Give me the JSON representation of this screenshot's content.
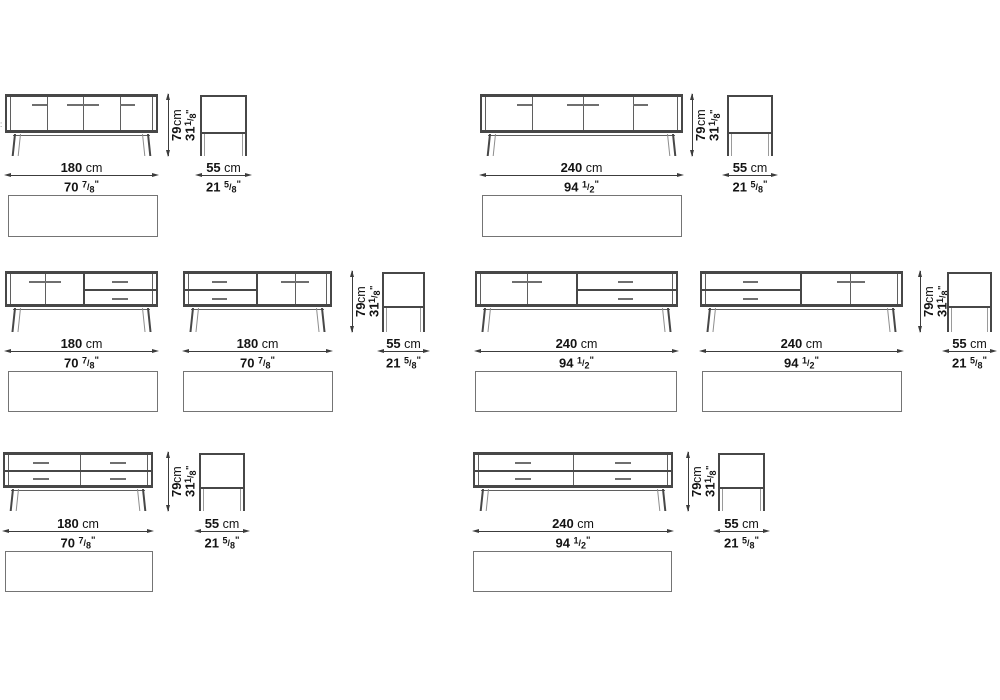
{
  "sheet": {
    "kind": "sideboard technical drawing spec sheet"
  },
  "colors": {
    "frame": "#474747",
    "thin": "#5f5f5f",
    "handle": "#6f6f6f",
    "dim": "#3c3c3c",
    "text": "#141414",
    "plan_border": "#747474"
  },
  "dim_labels": {
    "width_180": {
      "cm": "180",
      "cm_unit": "cm",
      "in": "70",
      "frac_n": "7",
      "frac_d": "8",
      "in_unit": "\""
    },
    "width_240": {
      "cm": "240",
      "cm_unit": "cm",
      "in": "94",
      "frac_n": "1",
      "frac_d": "2",
      "in_unit": "\""
    },
    "height": {
      "cm": "79",
      "cm_unit": "cm",
      "in": "31",
      "frac_n": "1",
      "frac_d": "8",
      "in_unit": "\""
    },
    "depth": {
      "cm": "55",
      "cm_unit": "cm",
      "in": "21",
      "frac_n": "5",
      "frac_d": "8",
      "in_unit": "\""
    }
  },
  "edge_artifact": {
    "text": ":",
    "x": 0,
    "y": 121
  },
  "rows": [
    {
      "front_top": 94,
      "body_h": 39,
      "leg_bottom": 156,
      "dim_cm_y": 161,
      "dim_line_y": 175,
      "dim_in_y": 178,
      "plan_y": 195,
      "plan_h": 42
    },
    {
      "front_top": 271,
      "body_h": 36,
      "leg_bottom": 332,
      "dim_cm_y": 337,
      "dim_line_y": 351,
      "dim_in_y": 354,
      "plan_y": 371,
      "plan_h": 41
    },
    {
      "front_top": 452,
      "body_h": 36,
      "leg_bottom": 511,
      "dim_cm_y": 517,
      "dim_line_y": 531,
      "dim_in_y": 534,
      "plan_y": 551,
      "plan_h": 41
    }
  ],
  "variants": [
    {
      "name": "sideboard-180-four-doors",
      "row": 0,
      "front": {
        "x": 5,
        "w": 153
      },
      "thin_vlines": [
        42,
        78,
        115
      ],
      "thick_vlines": [],
      "hline": null,
      "handles": [
        {
          "x1": 27,
          "x2": 42,
          "y": 10
        },
        {
          "x1": 62,
          "x2": 94,
          "y": 10
        },
        {
          "x1": 115,
          "x2": 130,
          "y": 10
        }
      ],
      "width_label": "width_180",
      "height_dim_x": 168,
      "side": {
        "x": 200,
        "w": 47
      },
      "plan": {
        "x": 8,
        "w": 150
      }
    },
    {
      "name": "sideboard-240-four-doors",
      "row": 0,
      "front": {
        "x": 480,
        "w": 203
      },
      "thin_vlines": [
        52,
        103,
        153
      ],
      "thick_vlines": [],
      "hline": null,
      "handles": [
        {
          "x1": 37,
          "x2": 52,
          "y": 10
        },
        {
          "x1": 87,
          "x2": 119,
          "y": 10
        },
        {
          "x1": 153,
          "x2": 168,
          "y": 10
        }
      ],
      "width_label": "width_240",
      "height_dim_x": 692,
      "side": {
        "x": 727,
        "w": 46
      },
      "plan": {
        "x": 482,
        "w": 200
      }
    },
    {
      "name": "sideboard-180-doors-left-drawers-right",
      "row": 1,
      "front": {
        "x": 5,
        "w": 153
      },
      "thin_vlines": [
        40
      ],
      "thick_vlines": [
        78
      ],
      "hline": {
        "x1": 78,
        "x2": 153
      },
      "handles": [
        {
          "x1": 24,
          "x2": 56,
          "y": 10
        },
        {
          "x1": 107,
          "x2": 123,
          "y": 10
        },
        {
          "x1": 107,
          "x2": 123,
          "y": 27
        }
      ],
      "width_label": "width_180",
      "height_dim_x": null,
      "side": null,
      "plan": {
        "x": 8,
        "w": 150
      }
    },
    {
      "name": "sideboard-180-drawers-left-doors-right",
      "row": 1,
      "front": {
        "x": 183,
        "w": 149
      },
      "thin_vlines": [
        112
      ],
      "thick_vlines": [
        73
      ],
      "hline": {
        "x1": 0,
        "x2": 73
      },
      "handles": [
        {
          "x1": 29,
          "x2": 44,
          "y": 10
        },
        {
          "x1": 29,
          "x2": 44,
          "y": 27
        },
        {
          "x1": 98,
          "x2": 126,
          "y": 10
        }
      ],
      "width_label": "width_180",
      "height_dim_x": 352,
      "side": {
        "x": 382,
        "w": 43
      },
      "plan": {
        "x": 183,
        "w": 150
      }
    },
    {
      "name": "sideboard-240-doors-left-drawers-right",
      "row": 1,
      "front": {
        "x": 475,
        "w": 203
      },
      "thin_vlines": [
        52
      ],
      "thick_vlines": [
        101
      ],
      "hline": {
        "x1": 101,
        "x2": 203
      },
      "handles": [
        {
          "x1": 37,
          "x2": 67,
          "y": 10
        },
        {
          "x1": 143,
          "x2": 158,
          "y": 10
        },
        {
          "x1": 143,
          "x2": 158,
          "y": 27
        }
      ],
      "width_label": "width_240",
      "height_dim_x": null,
      "side": null,
      "plan": {
        "x": 475,
        "w": 202
      }
    },
    {
      "name": "sideboard-240-drawers-left-doors-right",
      "row": 1,
      "front": {
        "x": 700,
        "w": 203
      },
      "thin_vlines": [
        150
      ],
      "thick_vlines": [
        100
      ],
      "hline": {
        "x1": 0,
        "x2": 100
      },
      "handles": [
        {
          "x1": 43,
          "x2": 58,
          "y": 10
        },
        {
          "x1": 43,
          "x2": 58,
          "y": 27
        },
        {
          "x1": 137,
          "x2": 165,
          "y": 10
        }
      ],
      "width_label": "width_240",
      "height_dim_x": 920,
      "side": {
        "x": 947,
        "w": 45
      },
      "plan": {
        "x": 702,
        "w": 200
      }
    },
    {
      "name": "sideboard-180-four-drawers",
      "row": 2,
      "front": {
        "x": 3,
        "w": 150
      },
      "thin_vlines": [
        77
      ],
      "thick_vlines": [],
      "hline": {
        "x1": 0,
        "x2": 150
      },
      "handles": [
        {
          "x1": 30,
          "x2": 46,
          "y": 10
        },
        {
          "x1": 107,
          "x2": 123,
          "y": 10
        },
        {
          "x1": 30,
          "x2": 46,
          "y": 26
        },
        {
          "x1": 107,
          "x2": 123,
          "y": 26
        }
      ],
      "width_label": "width_180",
      "height_dim_x": 168,
      "side": {
        "x": 199,
        "w": 46
      },
      "plan": {
        "x": 5,
        "w": 148
      }
    },
    {
      "name": "sideboard-240-four-drawers",
      "row": 2,
      "front": {
        "x": 473,
        "w": 200
      },
      "thin_vlines": [
        100
      ],
      "thick_vlines": [],
      "hline": {
        "x1": 0,
        "x2": 200
      },
      "handles": [
        {
          "x1": 42,
          "x2": 58,
          "y": 10
        },
        {
          "x1": 142,
          "x2": 158,
          "y": 10
        },
        {
          "x1": 42,
          "x2": 58,
          "y": 26
        },
        {
          "x1": 142,
          "x2": 158,
          "y": 26
        }
      ],
      "width_label": "width_240",
      "height_dim_x": 688,
      "side": {
        "x": 718,
        "w": 47
      },
      "plan": {
        "x": 473,
        "w": 199
      }
    }
  ]
}
